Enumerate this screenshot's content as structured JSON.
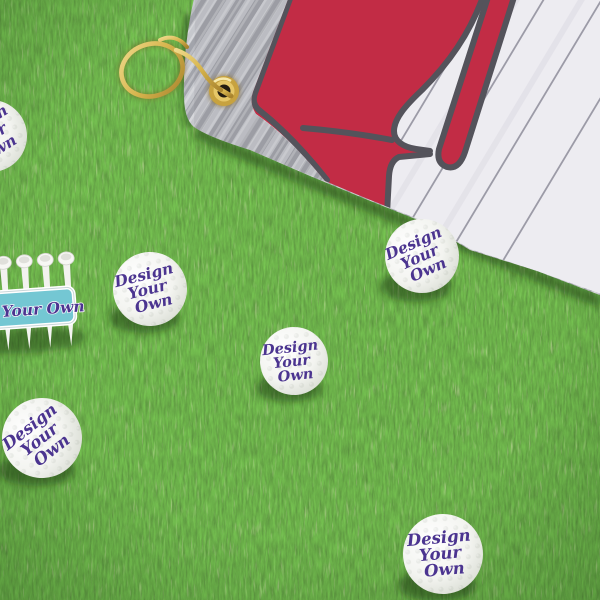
{
  "scene": {
    "type": "product-photo",
    "setting": "Customizable golf balls, a golf tee holder and a golf towel lying on artificial grass"
  },
  "ball_text": {
    "line1": "Design",
    "line2": "Your",
    "line3": "Own"
  },
  "tee_holder": {
    "label": "Your Own"
  },
  "colors": {
    "grass_green": "#4e8a31",
    "towel_red": "#c22c45",
    "outline_gray": "#54535b",
    "wood_white": "#edecf1",
    "plank_line_gray": "#8e8d9b",
    "knit_gray": "#b5b7bd",
    "gold": "#d7b54e",
    "ball_white": "#f4f4f1",
    "text_purple": "#4b3490",
    "label_teal": "#74c7d3"
  }
}
